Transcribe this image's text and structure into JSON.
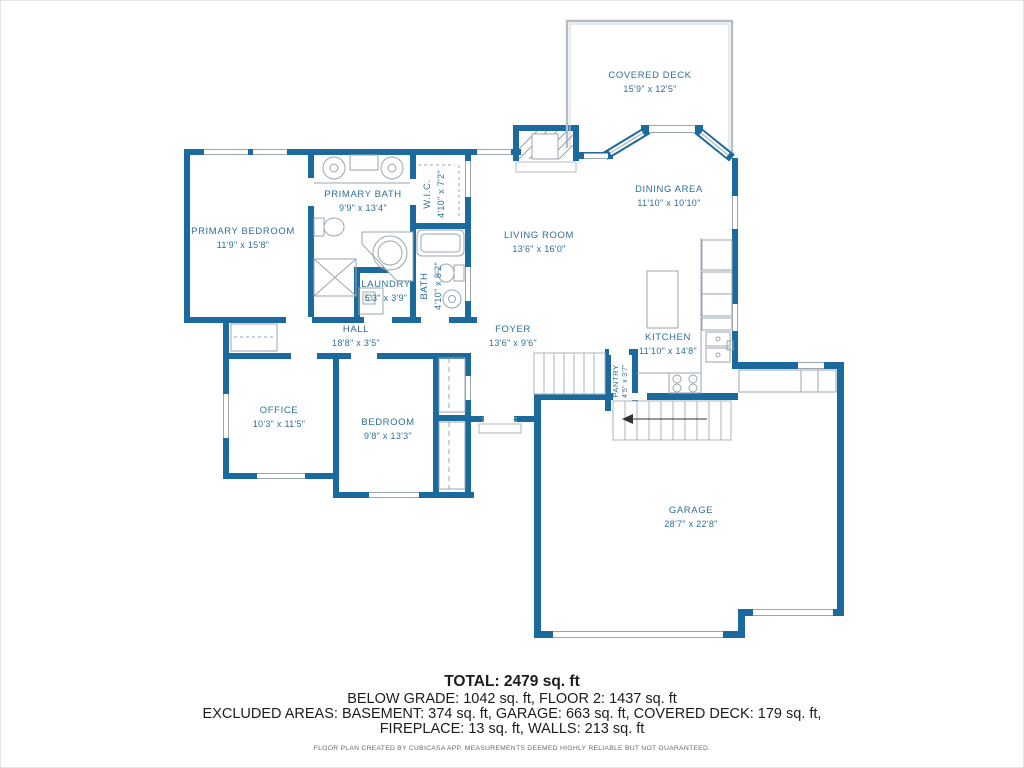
{
  "colors": {
    "wall": "#1b6a9d",
    "label": "#2d7099",
    "summary_text": "#1c1c1c",
    "footer_text": "#6a6a6a"
  },
  "rooms": {
    "covered_deck": {
      "name": "COVERED DECK",
      "dims": "15'9\" x 12'5\""
    },
    "dining_area": {
      "name": "DINING AREA",
      "dims": "11'10\" x 10'10\""
    },
    "living_room": {
      "name": "LIVING ROOM",
      "dims": "13'6\" x 16'0\""
    },
    "primary_bedroom": {
      "name": "PRIMARY BEDROOM",
      "dims": "11'9\" x 15'8\""
    },
    "primary_bath": {
      "name": "PRIMARY BATH",
      "dims": "9'9\" x 13'4\""
    },
    "wic": {
      "name": "W.I.C.",
      "dims": "4'10\" x 7'2\""
    },
    "laundry": {
      "name": "LAUNDRY",
      "dims": "5'3\" x 3'9\""
    },
    "bath": {
      "name": "BATH",
      "dims": "4'10\" x 8'2\""
    },
    "hall": {
      "name": "HALL",
      "dims": "18'8\" x 3'5\""
    },
    "foyer": {
      "name": "FOYER",
      "dims": "13'6\" x 9'6\""
    },
    "kitchen": {
      "name": "KITCHEN",
      "dims": "11'10\" x 14'8\""
    },
    "pantry": {
      "name": "PANTRY",
      "dims": "4'5\" x 3'7\""
    },
    "office": {
      "name": "OFFICE",
      "dims": "10'3\" x 11'5\""
    },
    "bedroom": {
      "name": "BEDROOM",
      "dims": "9'8\" x 13'3\""
    },
    "garage": {
      "name": "GARAGE",
      "dims": "28'7\" x 22'8\""
    }
  },
  "summary": {
    "total": "TOTAL: 2479 sq. ft",
    "below_grade_line": "BELOW GRADE: 1042 sq. ft, FLOOR 2: 1437 sq. ft",
    "excluded_line1": "EXCLUDED AREAS: BASEMENT: 374 sq. ft, GARAGE: 663 sq. ft, COVERED DECK: 179 sq. ft,",
    "excluded_line2": "FIREPLACE: 13 sq. ft, WALLS: 213 sq. ft"
  },
  "footer": {
    "note": "FLOOR PLAN CREATED BY CUBICASA APP. MEASUREMENTS DEEMED HIGHLY RELIABLE BUT NOT GUARANTEED."
  }
}
